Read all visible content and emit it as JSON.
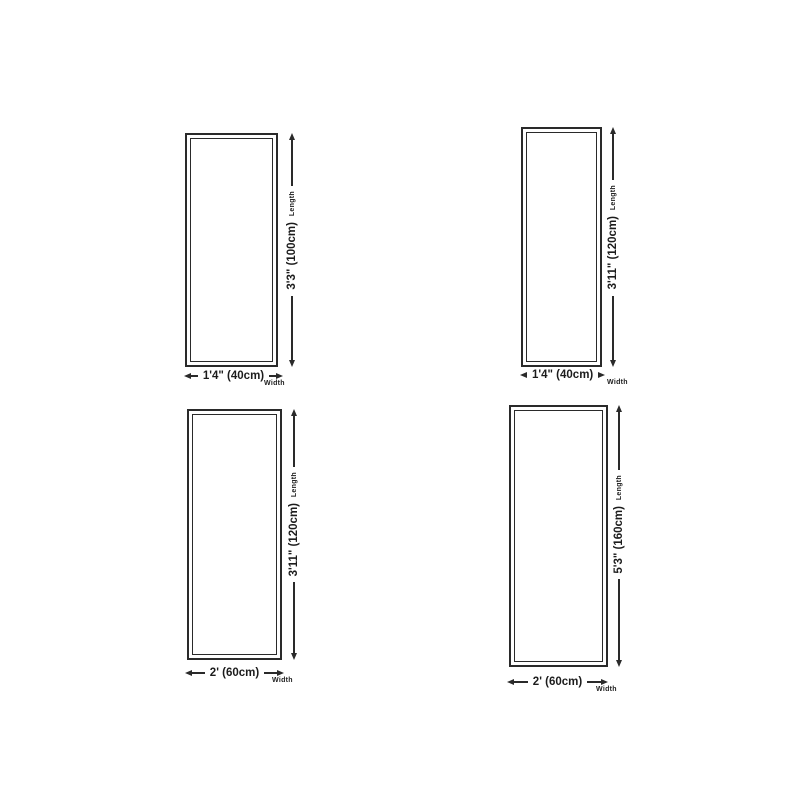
{
  "page": {
    "background_color": "#ffffff",
    "line_color": "#2a2a2a",
    "text_color": "#1c1c1c"
  },
  "panels": [
    {
      "name": "runner-size-40x100",
      "length_label": "3'3\" (100cm)",
      "length_caption": "Length",
      "width_label": "1'4\" (40cm)",
      "width_caption": "Width"
    },
    {
      "name": "runner-size-40x120",
      "length_label": "3'11\" (120cm)",
      "length_caption": "Length",
      "width_label": "1'4\" (40cm)",
      "width_caption": "Width"
    },
    {
      "name": "runner-size-60x120",
      "length_label": "3'11\" (120cm)",
      "length_caption": "Length",
      "width_label": "2' (60cm)",
      "width_caption": "Width"
    },
    {
      "name": "runner-size-60x160",
      "length_label": "5'3\" (160cm)",
      "length_caption": "Length",
      "width_label": "2' (60cm)",
      "width_caption": "Width"
    }
  ]
}
